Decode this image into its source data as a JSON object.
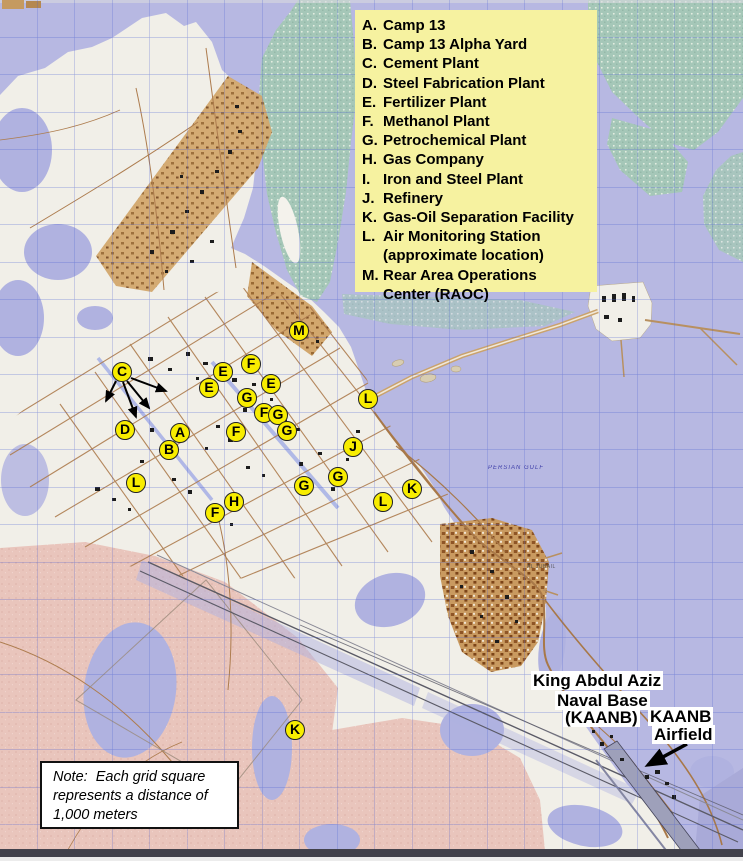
{
  "colors": {
    "water": "#b7b8e2",
    "land": "#f1efe8",
    "legend_bg": "#f6f2a0",
    "marker_yellow": "#f8ed00",
    "sand_pink": "#e9c5bc",
    "vegetation": "#a5c7b8",
    "urban_tan": "#d0a46a",
    "note_bg": "#ffffff"
  },
  "legend": {
    "rows": [
      {
        "letter": "A.",
        "text": "Camp 13"
      },
      {
        "letter": "B.",
        "text": "Camp 13 Alpha Yard"
      },
      {
        "letter": "C.",
        "text": "Cement Plant"
      },
      {
        "letter": "D.",
        "text": "Steel Fabrication Plant"
      },
      {
        "letter": "E.",
        "text": "Fertilizer Plant"
      },
      {
        "letter": "F.",
        "text": "Methanol Plant"
      },
      {
        "letter": "G.",
        "text": "Petrochemical Plant"
      },
      {
        "letter": "H.",
        "text": "Gas Company"
      },
      {
        "letter": "I.",
        "text": "Iron and Steel Plant"
      },
      {
        "letter": "J.",
        "text": "Refinery"
      },
      {
        "letter": "K.",
        "text": "Gas-Oil Separation Facility"
      },
      {
        "letter": "L.",
        "text": "Air Monitoring Station"
      },
      {
        "letter": "",
        "text": "(approximate location)"
      },
      {
        "letter": "M.",
        "text": "Rear Area Operations"
      },
      {
        "letter": "",
        "text": "Center (RAOC)"
      }
    ]
  },
  "map": {
    "markers": [
      {
        "letter": "C",
        "x": 122,
        "y": 372
      },
      {
        "letter": "F",
        "x": 251,
        "y": 364
      },
      {
        "letter": "E",
        "x": 223,
        "y": 372
      },
      {
        "letter": "E",
        "x": 209,
        "y": 388
      },
      {
        "letter": "E",
        "x": 271,
        "y": 384
      },
      {
        "letter": "G",
        "x": 247,
        "y": 398
      },
      {
        "letter": "F",
        "x": 264,
        "y": 413
      },
      {
        "letter": "G",
        "x": 278,
        "y": 415
      },
      {
        "letter": "G",
        "x": 287,
        "y": 431
      },
      {
        "letter": "F",
        "x": 236,
        "y": 432
      },
      {
        "letter": "D",
        "x": 125,
        "y": 430
      },
      {
        "letter": "A",
        "x": 180,
        "y": 433
      },
      {
        "letter": "B",
        "x": 169,
        "y": 450
      },
      {
        "letter": "L",
        "x": 136,
        "y": 483
      },
      {
        "letter": "G",
        "x": 304,
        "y": 486
      },
      {
        "letter": "H",
        "x": 234,
        "y": 502
      },
      {
        "letter": "F",
        "x": 215,
        "y": 513
      },
      {
        "letter": "M",
        "x": 299,
        "y": 331
      },
      {
        "letter": "L",
        "x": 368,
        "y": 399
      },
      {
        "letter": "J",
        "x": 353,
        "y": 447
      },
      {
        "letter": "G",
        "x": 338,
        "y": 477
      },
      {
        "letter": "K",
        "x": 412,
        "y": 489
      },
      {
        "letter": "L",
        "x": 383,
        "y": 502
      },
      {
        "letter": "K",
        "x": 295,
        "y": 730
      }
    ],
    "arrows": [
      {
        "x1": 116,
        "y1": 381,
        "x2": 106,
        "y2": 401,
        "size": "s"
      },
      {
        "x1": 123,
        "y1": 382,
        "x2": 136,
        "y2": 417,
        "size": "s"
      },
      {
        "x1": 127,
        "y1": 381,
        "x2": 149,
        "y2": 408,
        "size": "s"
      },
      {
        "x1": 131,
        "y1": 378,
        "x2": 166,
        "y2": 391,
        "size": "s"
      },
      {
        "x1": 687,
        "y1": 744,
        "x2": 648,
        "y2": 765,
        "size": "l"
      }
    ],
    "labels": {
      "naval_base": [
        "King Abdul Aziz",
        "Naval Base",
        "(KAANB)"
      ],
      "airfield": [
        "KAANB",
        "Airfield"
      ],
      "sea": "PERSIAN GULF",
      "town": "AL JUBAIL"
    },
    "note_lines": [
      "Note:  Each grid square",
      "represents a distance of",
      "1,000 meters"
    ]
  }
}
